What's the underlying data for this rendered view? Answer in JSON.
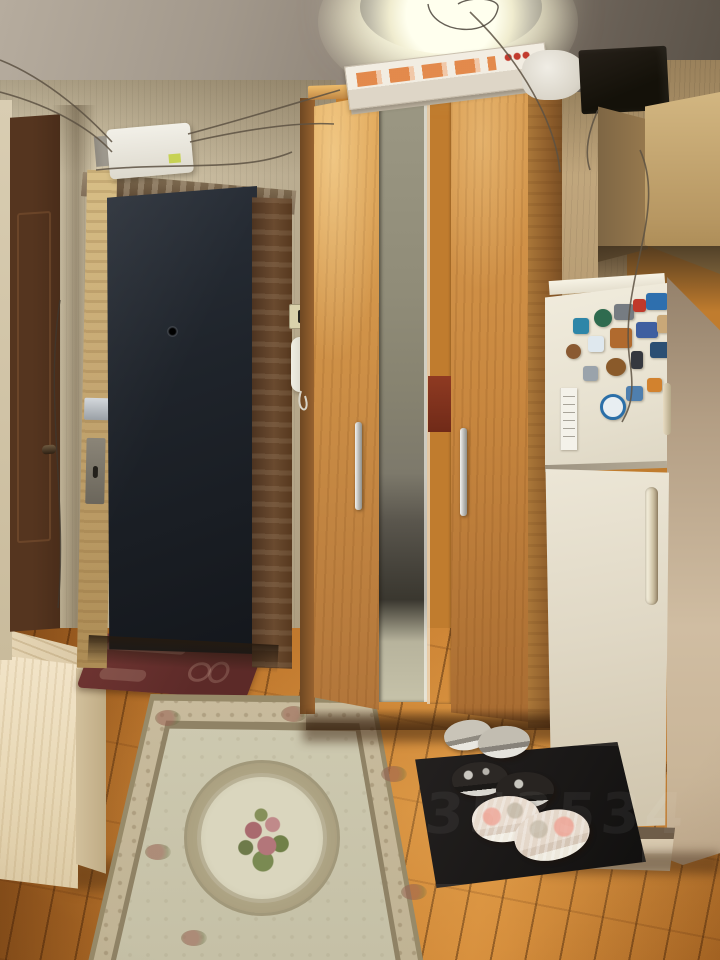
{
  "page": {
    "title": "Apartment hallway photo"
  },
  "watermark": {
    "text": "353534"
  },
  "colors": {
    "floor": "#c67d30",
    "rug_field": "#cecab1",
    "doormat": "#6e3431",
    "interior_door": "#55351f",
    "entry_door": "#1f242b",
    "door_edge_wood": "#c6a873",
    "door_frame": "#6a4a2f",
    "wardrobe_wood": "#cd8f46",
    "fridge_front": "#e8e2d1",
    "fridge_side": "#d0bda2",
    "cabinet_front": "#b79762",
    "black_box": "#141109"
  },
  "objects": {
    "ceiling": "glossy stretch ceiling",
    "ceiling_light": "round ceiling light",
    "left_wall": "beige striped wallpaper",
    "right_wall": "tan wallpaper strip",
    "interior_door": "brown interior door",
    "entry_door": "dark entrance door standing open",
    "door_edge": "door edge with mortise locks",
    "peephole": "door peephole",
    "door_frame": "wooden door frame",
    "junction_box": "white junction box with wires",
    "light_switch": "light switch",
    "intercom": "intercom handset",
    "wardrobe": "corner wardrobe with mirrored doors",
    "wardrobe_handle": "wardrobe door handle",
    "mirror": "mirror strip reflecting room doorway",
    "cardboard_box": "flat cardboard box on wardrobe top",
    "plastic_bag": "white plastic bag",
    "black_box": "black box on wardrobe top",
    "overhead_cabinet": "overhead cabinet above fridge",
    "fridge": "refrigerator covered with souvenir magnets",
    "fridge_handle": "fridge door handle",
    "paper_list": "paper note on freezer door",
    "floor": "orange parquet floor",
    "rug": "pale floral rug with medallion",
    "doormat": "dark red doormat",
    "bench": "light wood shoe bench",
    "shoe_tray": "black shoe tray",
    "shoes_gray": "gray sneakers",
    "shoes_black": "black sneakers",
    "shoes_pink": "white and pink sneakers"
  },
  "fridge": {
    "magnets": [
      {
        "x": 28,
        "y": 35,
        "w": 16,
        "h": 16,
        "color": "#2e86a8"
      },
      {
        "x": 49,
        "y": 26,
        "w": 18,
        "h": 18,
        "color": "#2f6b4f",
        "round": true
      },
      {
        "x": 69,
        "y": 21,
        "w": 20,
        "h": 16,
        "color": "#767c82"
      },
      {
        "x": 88,
        "y": 16,
        "w": 13,
        "h": 13,
        "color": "#c0392b"
      },
      {
        "x": 101,
        "y": 10,
        "w": 22,
        "h": 17,
        "color": "#2e6fae"
      },
      {
        "x": 21,
        "y": 61,
        "w": 15,
        "h": 15,
        "color": "#8a5a32",
        "round": true
      },
      {
        "x": 43,
        "y": 53,
        "w": 16,
        "h": 16,
        "color": "#dfe8ee"
      },
      {
        "x": 65,
        "y": 45,
        "w": 22,
        "h": 20,
        "color": "#b06a2e"
      },
      {
        "x": 91,
        "y": 39,
        "w": 22,
        "h": 16,
        "color": "#3f5fa0"
      },
      {
        "x": 112,
        "y": 32,
        "w": 12,
        "h": 18,
        "color": "#c9a878"
      },
      {
        "x": 38,
        "y": 83,
        "w": 15,
        "h": 15,
        "color": "#9aa3ab"
      },
      {
        "x": 61,
        "y": 75,
        "w": 20,
        "h": 18,
        "color": "#8a5a2a",
        "round": true
      },
      {
        "x": 86,
        "y": 68,
        "w": 12,
        "h": 18,
        "color": "#35383f"
      },
      {
        "x": 105,
        "y": 59,
        "w": 22,
        "h": 16,
        "color": "#2b4f73"
      },
      {
        "x": 55,
        "y": 111,
        "w": 26,
        "h": 26,
        "color": "#2b6fa8",
        "ring": true
      },
      {
        "x": 81,
        "y": 103,
        "w": 17,
        "h": 15,
        "color": "#4f7fae"
      },
      {
        "x": 102,
        "y": 95,
        "w": 15,
        "h": 14,
        "color": "#d2822e"
      }
    ]
  }
}
